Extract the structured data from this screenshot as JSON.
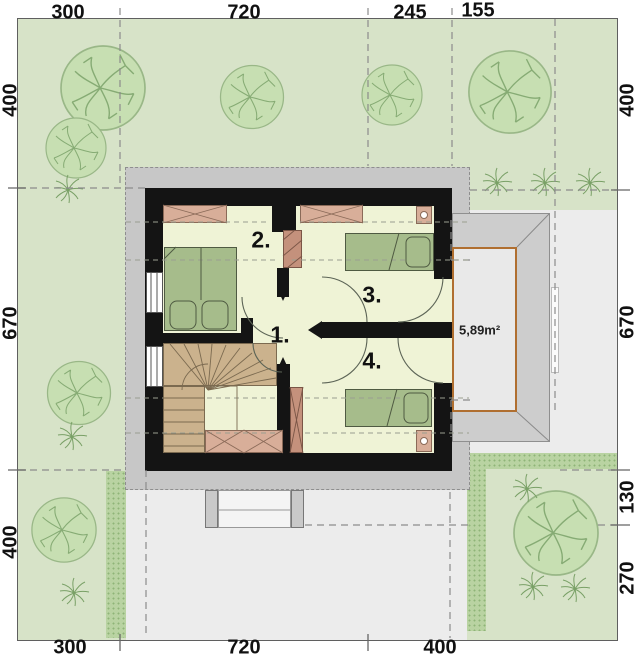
{
  "dimensions": {
    "top": [
      "300",
      "720",
      "245",
      "155"
    ],
    "right": [
      "400",
      "670",
      "130",
      "270"
    ],
    "bottom": [
      "300",
      "720",
      "400"
    ],
    "left": [
      "400",
      "670",
      "400"
    ]
  },
  "rooms": {
    "r1": "1.",
    "r2": "2.",
    "r3": "3.",
    "r4": "4."
  },
  "terrace": {
    "area": "5,89m²"
  },
  "colors": {
    "lawn": "#d7e3c8",
    "paving": "#ececec",
    "roof_outline": "#c7c7c7",
    "wall": "#141414",
    "floor": "#eff3d6",
    "bed": "#a6bc8b",
    "wardrobe": "#d8ae99",
    "stairs": "#cbb28d",
    "chimney": "#c4917c",
    "terrace_border": "#b06f30",
    "hedge": "#b9d3a2",
    "tree": "#c7dfb2"
  }
}
